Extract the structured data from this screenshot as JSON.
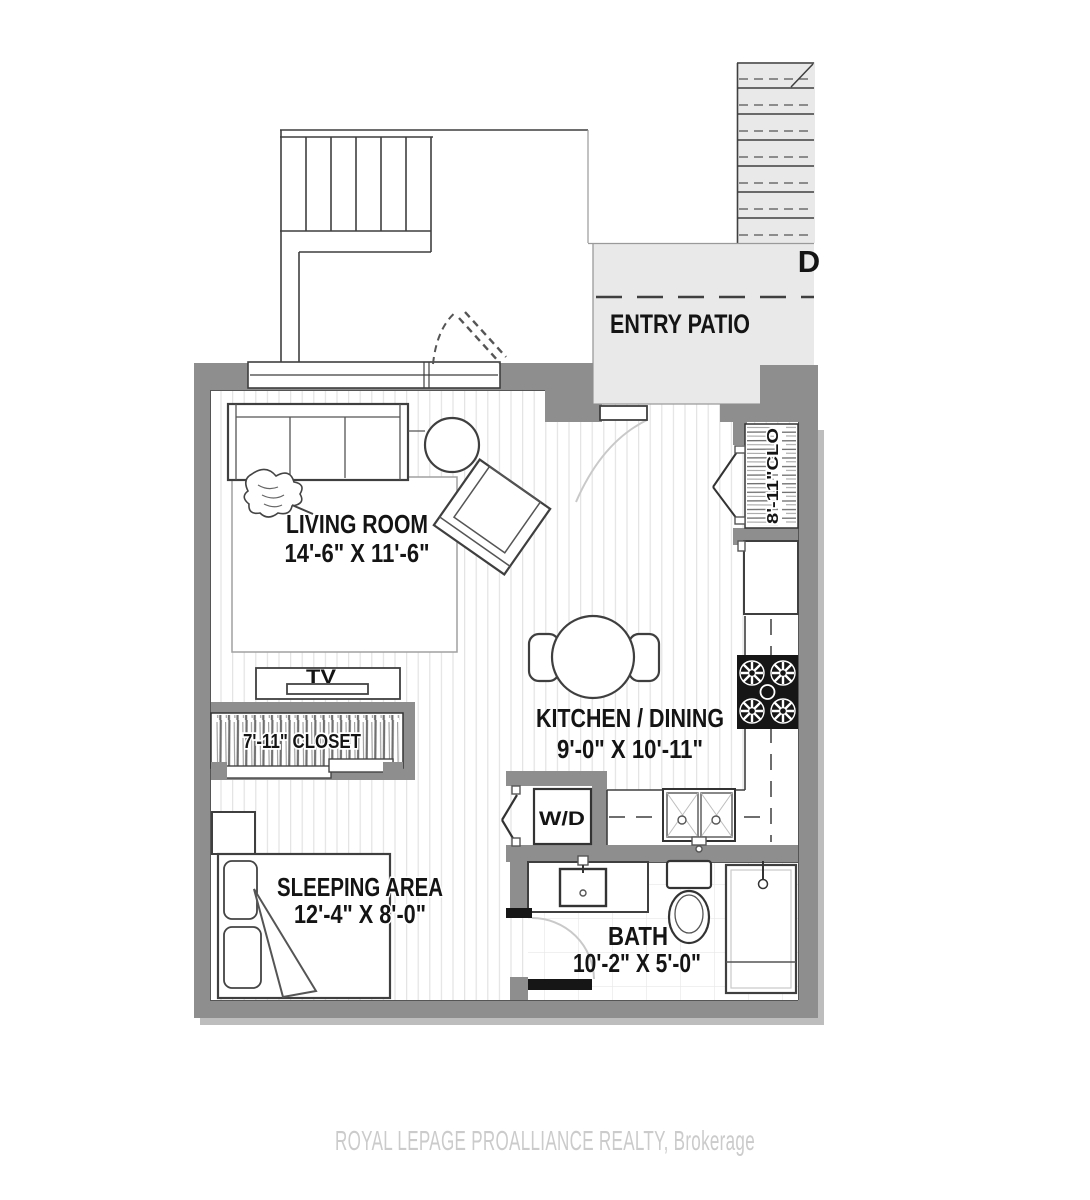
{
  "watermark": "ROYAL LEPAGE PROALLIANCE REALTY, Brokerage",
  "exterior": {
    "entry_patio_label": "ENTRY PATIO",
    "stair_direction_label": "D"
  },
  "rooms": {
    "living_room": {
      "name": "LIVING ROOM",
      "dimensions": "14'-6\" X 11'-6\""
    },
    "kitchen_dining": {
      "name": "KITCHEN / DINING",
      "dimensions": "9'-0\" X 10'-11\""
    },
    "sleeping_area": {
      "name": "SLEEPING AREA",
      "dimensions": "12'-4\" X 8'-0\""
    },
    "bath": {
      "name": "BATH",
      "dimensions": "10'-2\" X 5'-0\""
    }
  },
  "closets": {
    "bedroom_closet_label": "7'-11\" CLOSET",
    "entry_closet_label": "8'-11\"CLO"
  },
  "fixtures": {
    "tv_label": "TV",
    "washer_dryer_label": "W/D"
  },
  "colors": {
    "wall": "#8e8e8e",
    "patio_fill": "#e9e9e9",
    "line": "#3f3f3f",
    "fixture_black": "#161616",
    "floor_line": "#e3e3e3",
    "watermark_text": "#cbcbcb"
  }
}
